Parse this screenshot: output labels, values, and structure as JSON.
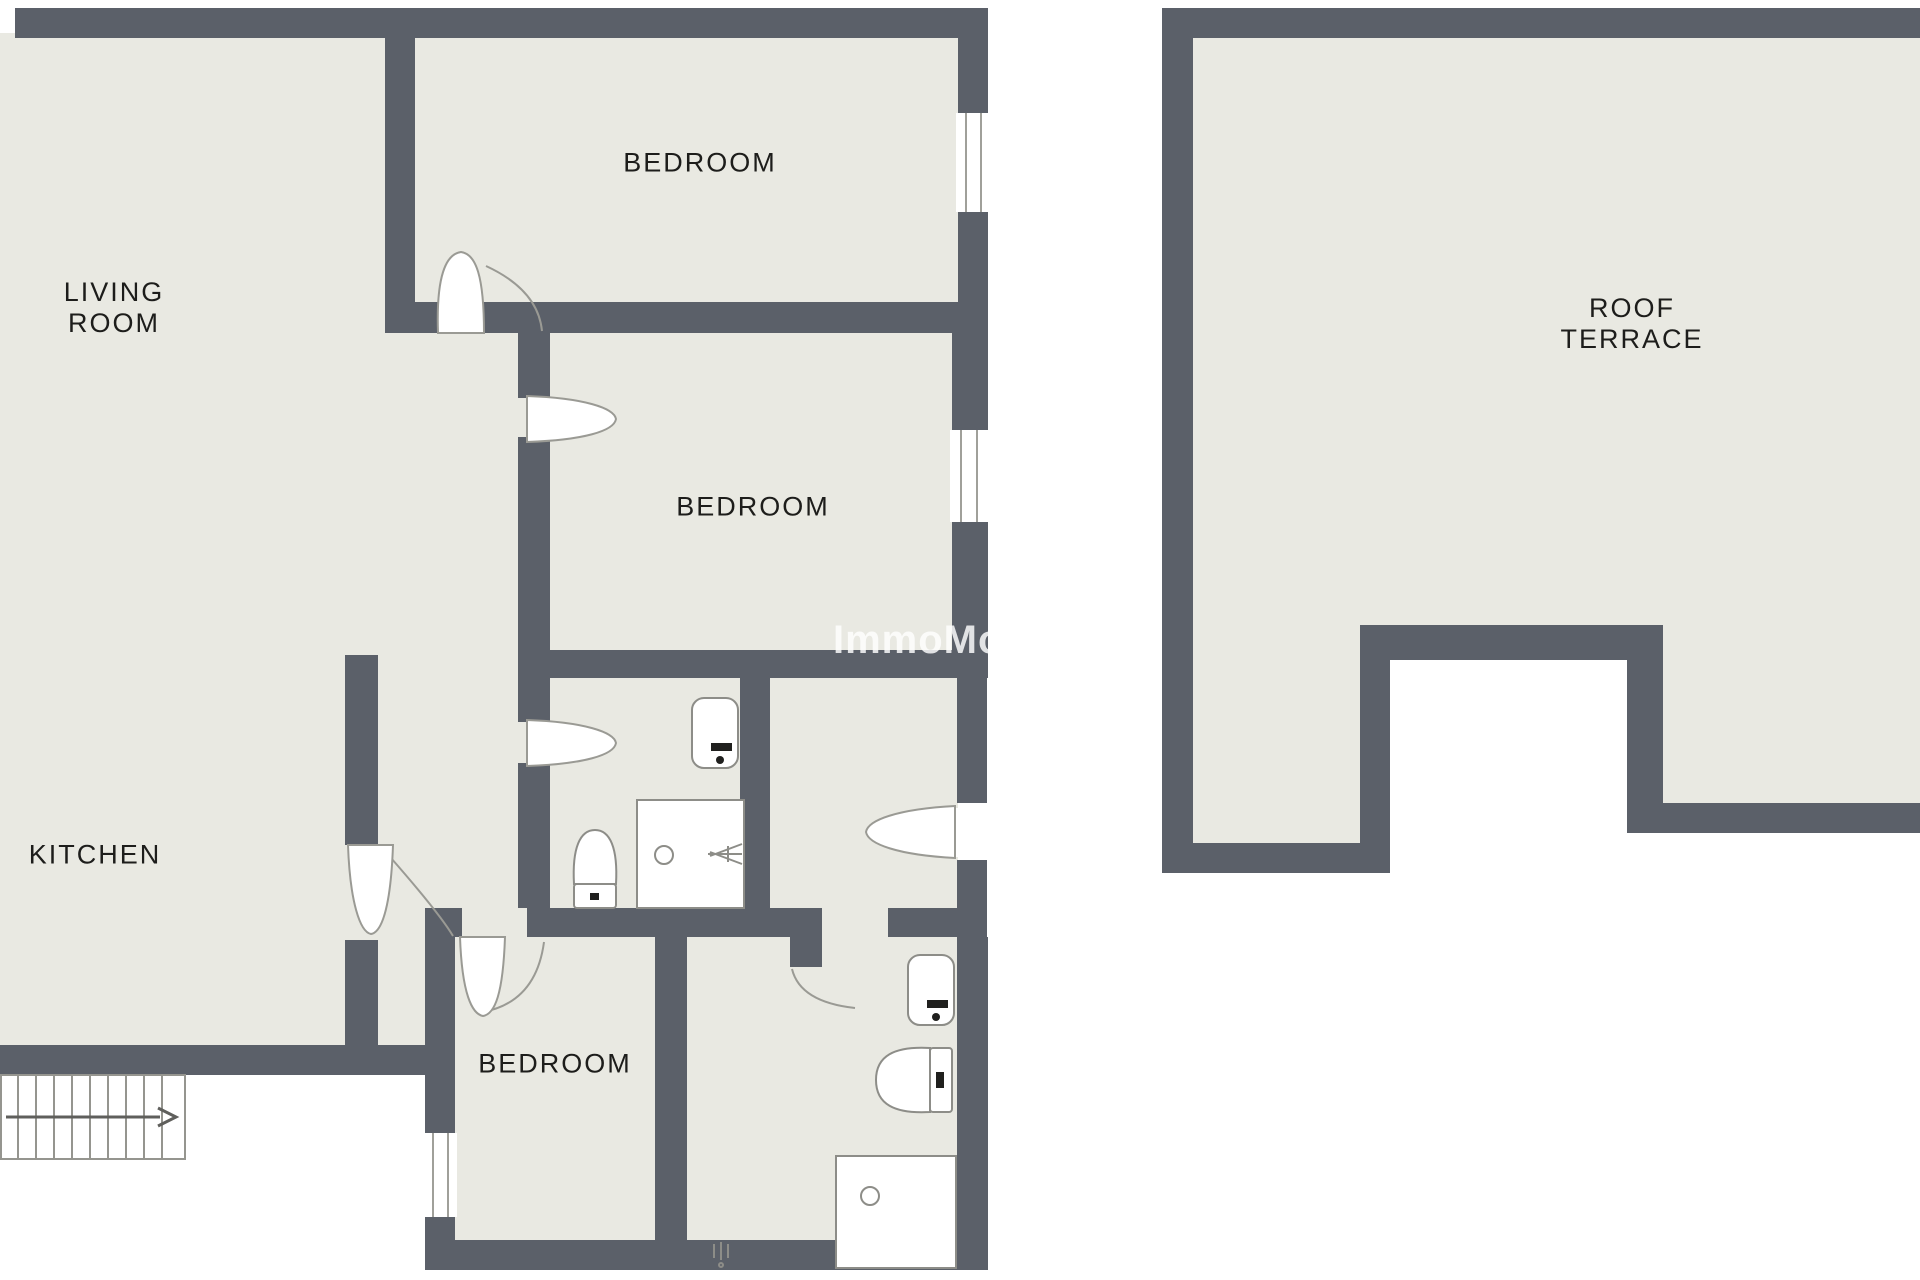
{
  "colors": {
    "bg": "#ffffff",
    "floor": "#e9e9e2",
    "wall": "#5b6069",
    "label": "#1d1d1b",
    "fixture": "#8d8d88",
    "watermark": "#ffffff"
  },
  "rooms": {
    "living_room": {
      "line1": "LIVING",
      "line2": "ROOM"
    },
    "bedroom_top": {
      "label": "BEDROOM"
    },
    "bedroom_middle": {
      "label": "BEDROOM"
    },
    "bedroom_bottom": {
      "label": "BEDROOM"
    },
    "kitchen": {
      "label": "KITCHEN"
    },
    "roof_terrace": {
      "line1": "ROOF",
      "line2": "TERRACE"
    }
  },
  "watermark": {
    "text": "ImmoMoment"
  }
}
